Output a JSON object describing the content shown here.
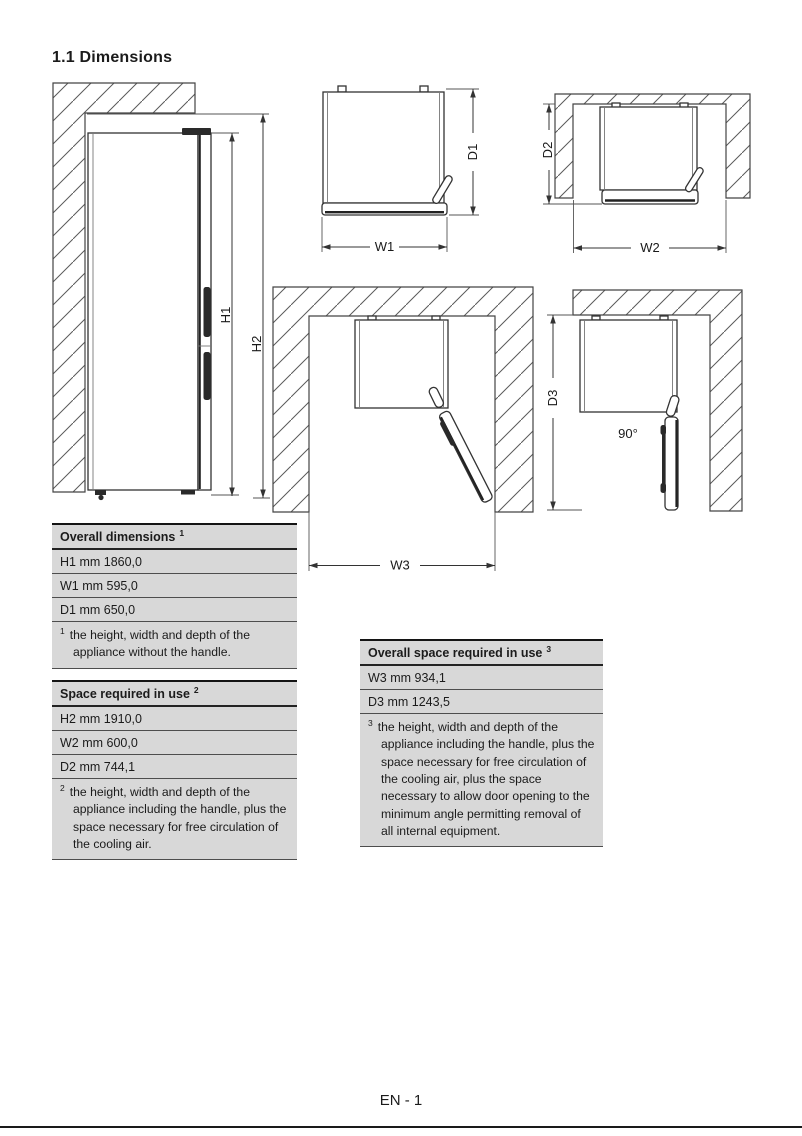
{
  "page": {
    "title": "1.1 Dimensions",
    "footer_page": "EN - 1"
  },
  "diagrams": {
    "side_view": {
      "h1": "H1",
      "h2": "H2"
    },
    "top_view_overall": {
      "w1": "W1",
      "d1": "D1"
    },
    "top_view_space": {
      "w2": "W2",
      "d2": "D2"
    },
    "top_view_door_open": {
      "w3": "W3"
    },
    "top_view_door_90": {
      "d3": "D3",
      "angle": "90°"
    }
  },
  "tables": [
    {
      "header": "Overall dimensions",
      "header_sup": "1",
      "rows": [
        "H1 mm 1860,0",
        "W1 mm 595,0",
        "D1 mm 650,0"
      ],
      "footnote_sup": "1",
      "footnote": "the height, width and depth of the appliance without the handle."
    },
    {
      "header": "Space required in use",
      "header_sup": "2",
      "rows": [
        "H2 mm 1910,0",
        "W2 mm 600,0",
        "D2 mm 744,1"
      ],
      "footnote_sup": "2",
      "footnote": "the height, width and depth of the appliance including the handle, plus the space necessary for free circulation of the cooling air."
    },
    {
      "header": "Overall space required in use",
      "header_sup": "3",
      "rows": [
        "W3 mm 934,1",
        "D3 mm 1243,5"
      ],
      "footnote_sup": "3",
      "footnote": "the height, width and depth of the appliance including the handle, plus the space necessary for free circulation of the cooling air, plus the space necessary to allow door opening to the minimum angle permitting removal of all internal equipment."
    }
  ]
}
